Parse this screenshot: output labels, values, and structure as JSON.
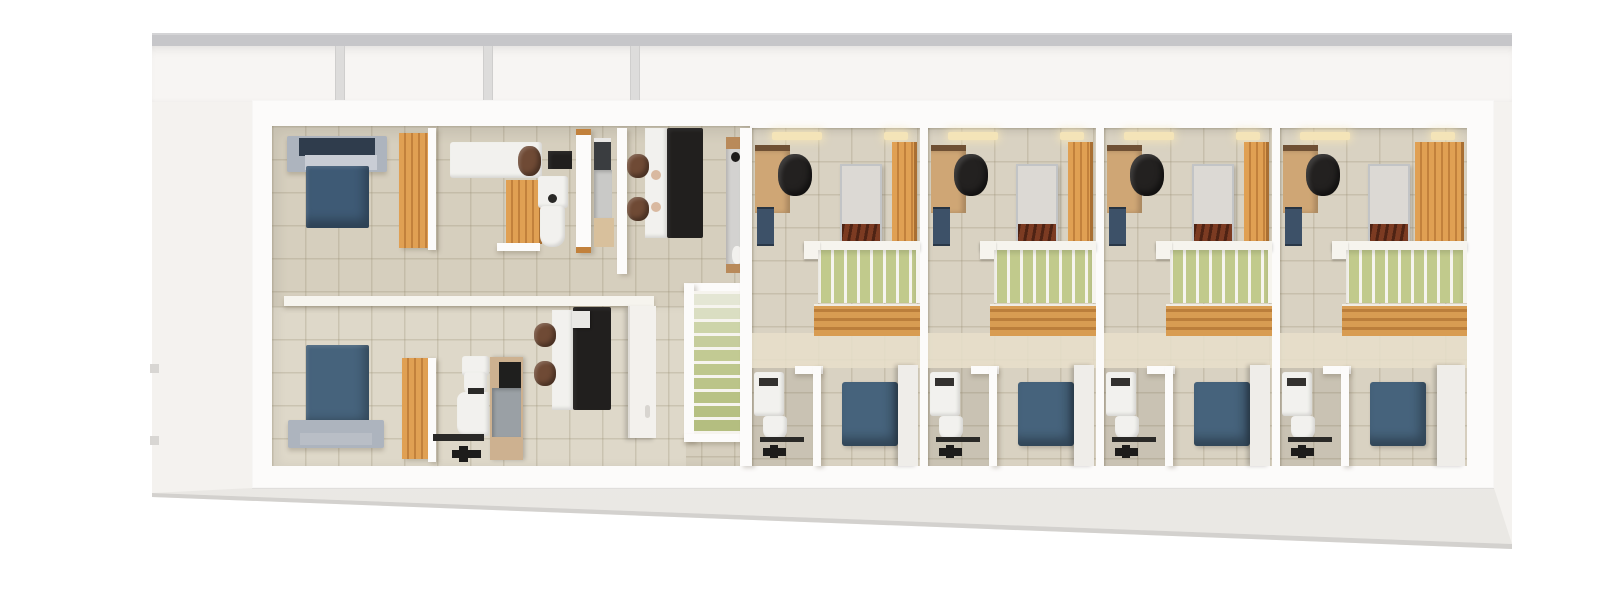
{
  "scene": {
    "type": "3d-floorplan-render",
    "description": "Top-down 3D architectural render of a narrow single-storey layout: private suite with two blue double beds, bathrooms and study areas on the left, a central green staircase, and four identical duplex guest units on the right, each with desk, single bed, wardrobe, green loft void, bathroom and blue double bed.",
    "visible_text": []
  },
  "palette": {
    "bg": "#ffffff",
    "platform": "#f4f2ef",
    "roof": "#c6c6c9",
    "pane": "#f7f5f3",
    "mullion": "#dddcdb",
    "wall": "#fcfbfa",
    "tileA": "#d6cfbe",
    "tileB": "#ded8c9",
    "tileC": "#d9d2c2",
    "cream": "#e8dfca",
    "grout": "rgba(151,140,114,0.28)",
    "blue": "#3e5a75",
    "blueBtm": "#46637c",
    "navyIn": "#2f3c4c",
    "silver": "#adb4be",
    "silverLt": "#c9cdd5",
    "orange": "#e0a053",
    "orangeDk": "#c2813c",
    "orangeEdge": "#a96f33",
    "tan": "#cfa675",
    "tanCap": "#6f5034",
    "slat": "#d89c52",
    "slatDk": "#bb7e3b",
    "green": "#c1ca8c",
    "rail": "#f6f4ee",
    "black": "#1d1c1b",
    "charcoal": "#2a2927",
    "brown": "#6f4a35",
    "rust": "#7c3b22",
    "matt": "#dcd9d4",
    "fix": "#f2f1ee",
    "grayP": "#d3d2d0",
    "shower": "#9aa0a5",
    "amber": "#f4e4b8",
    "bench": "#3d5168",
    "deskBlk": "#211f1e",
    "deskChair": "#232120",
    "door": "#f3f1ed",
    "trayC": "#cdb190"
  },
  "left_suite": {
    "rooms": [
      {
        "name": "bedroom-north",
        "furniture": [
          "double-bed-blue",
          "silver-bed-frame",
          "wardrobe-oak"
        ]
      },
      {
        "name": "bathroom-north",
        "furniture": [
          "white-vanity-desk",
          "brown-chair",
          "wall-tv",
          "oak-cabinet",
          "washbasin",
          "toilet"
        ]
      },
      {
        "name": "shower-room-north",
        "furniture": [
          "shower-glass",
          "shower-tray",
          "oak-bench"
        ]
      },
      {
        "name": "study-north",
        "furniture": [
          "white-desk",
          "black-sideboard",
          "brown-chair",
          "brown-chair",
          "plates"
        ]
      },
      {
        "name": "kitchenette-east",
        "furniture": [
          "gray-counter",
          "oak-caps",
          "hob-knob",
          "white-dishes"
        ]
      },
      {
        "name": "bedroom-south",
        "furniture": [
          "double-bed-blue",
          "silver-bed-frame",
          "wardrobe-oak"
        ]
      },
      {
        "name": "bathroom-south",
        "furniture": [
          "toilet",
          "washbasin",
          "towel-rail",
          "shower-stall",
          "bath-mat"
        ]
      },
      {
        "name": "office-south",
        "furniture": [
          "white-desk",
          "black-desk",
          "laptop",
          "brown-chair",
          "brown-chair",
          "white-door"
        ]
      }
    ]
  },
  "staircase": {
    "name": "central-staircase",
    "tread_count": 10,
    "treads": [
      "#e4e6d4",
      "#dadec2",
      "#cdd4a9",
      "#c6cd9c",
      "#c2ca93",
      "#bec78d",
      "#bbc489",
      "#b8c285",
      "#b6c082",
      "#b4be80"
    ]
  },
  "guest_units": {
    "count": 4,
    "ids": [
      "unit-1",
      "unit-2",
      "unit-3",
      "unit-4"
    ],
    "furniture_per_unit": [
      "ceiling-light",
      "ceiling-light",
      "oak-desk",
      "office-chair",
      "blue-bench",
      "single-bed-white",
      "rust-blanket",
      "wardrobe-oak",
      "loft-railing",
      "loft-void-green",
      "wood-slat-stair",
      "washbasin-unit",
      "toilet",
      "towel-rail",
      "bath-mat",
      "double-bed-blue",
      "headboard-white"
    ]
  }
}
